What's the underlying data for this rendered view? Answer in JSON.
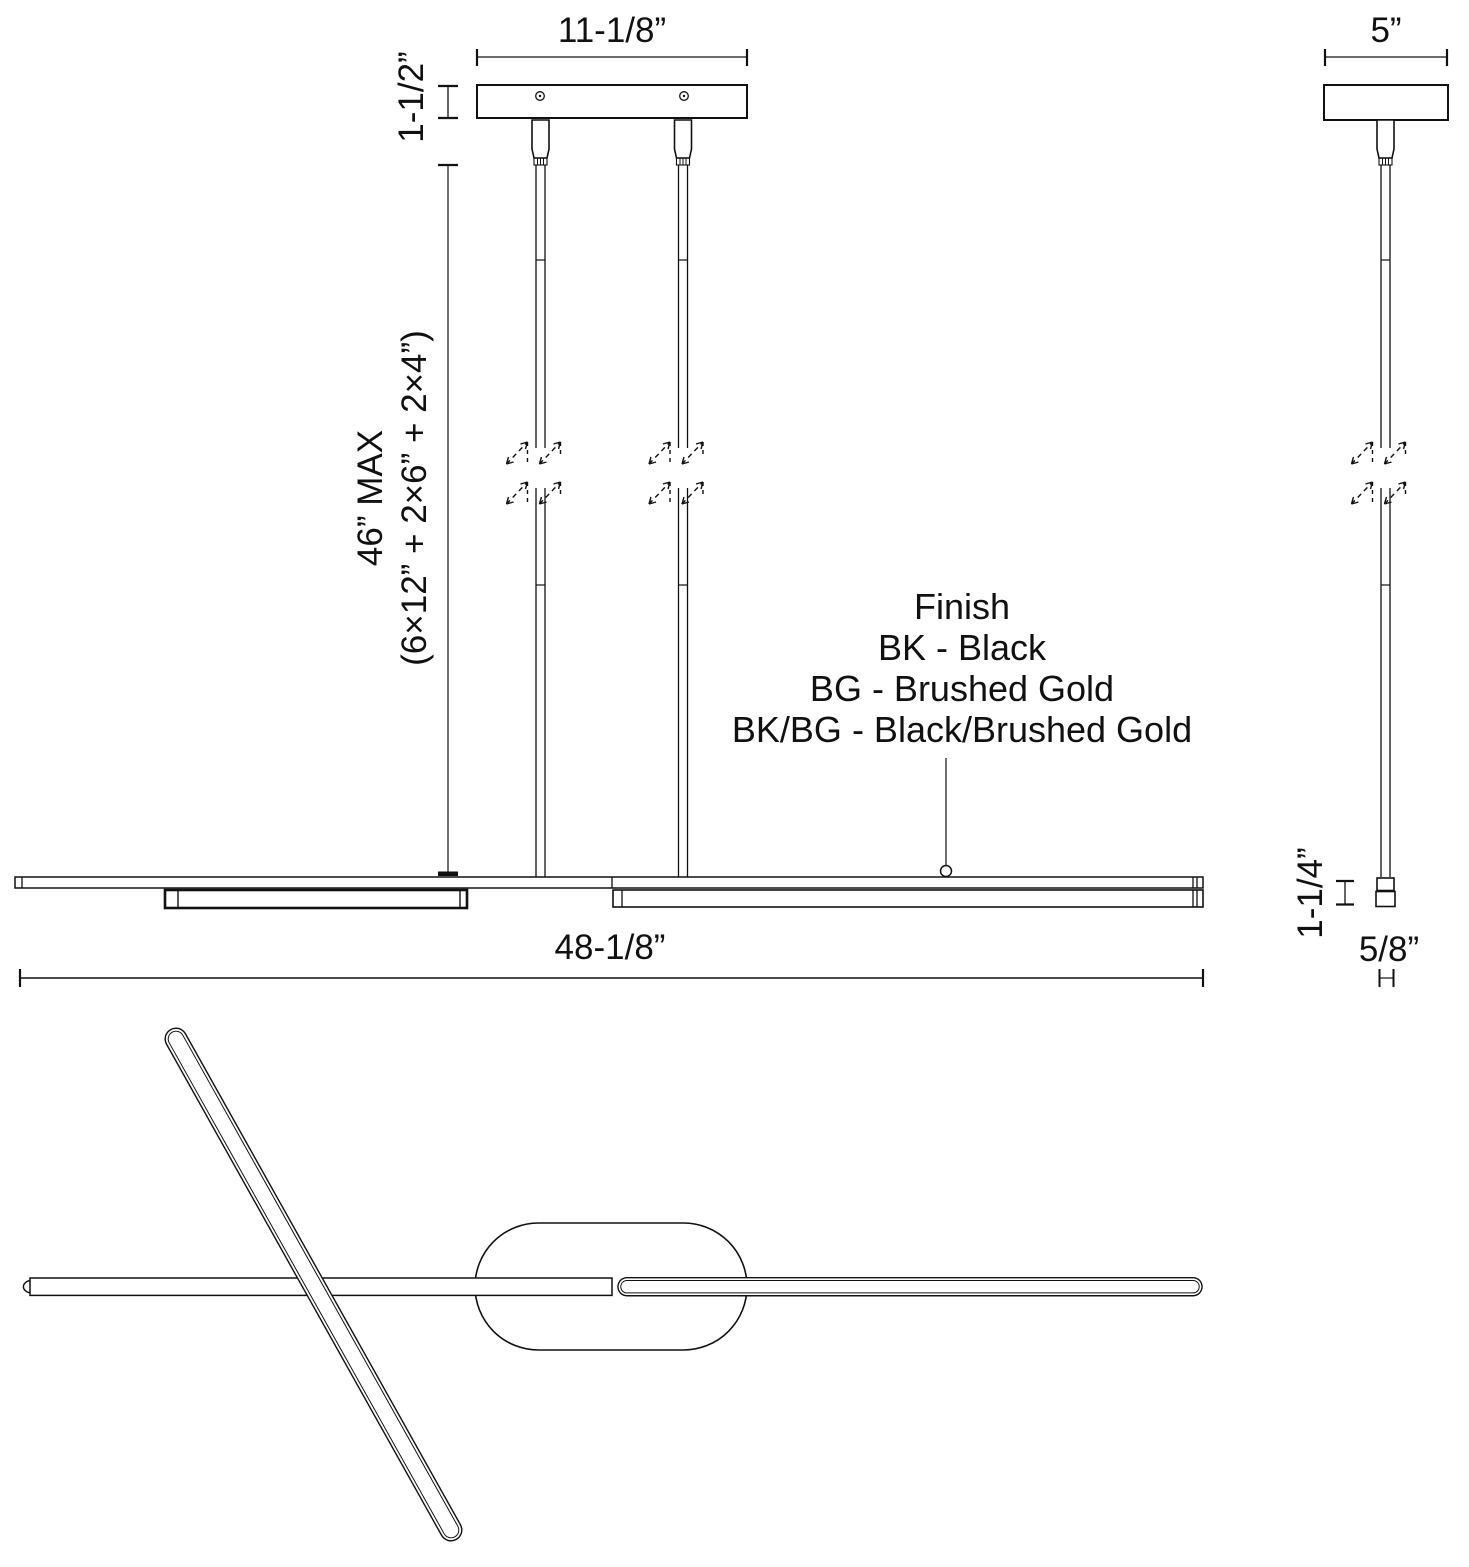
{
  "page": {
    "background": "#ffffff",
    "line_color": "#111111"
  },
  "front_view": {
    "canopy_width_label": "11-1/8”",
    "canopy_height_label": "1-1/2”",
    "suspension_max_label": "46” MAX",
    "suspension_formula_label": "(6×12” + 2×6” + 2×4”)",
    "fixture_width_label": "48-1/8”"
  },
  "side_view": {
    "canopy_width_label": "5”",
    "fixture_height_label": "1-1/4”",
    "fixture_depth_label": "5/8”"
  },
  "finish_legend": {
    "title": "Finish",
    "options": [
      "BK - Black",
      "BG - Brushed Gold",
      "BK/BG - Black/Brushed Gold"
    ]
  }
}
